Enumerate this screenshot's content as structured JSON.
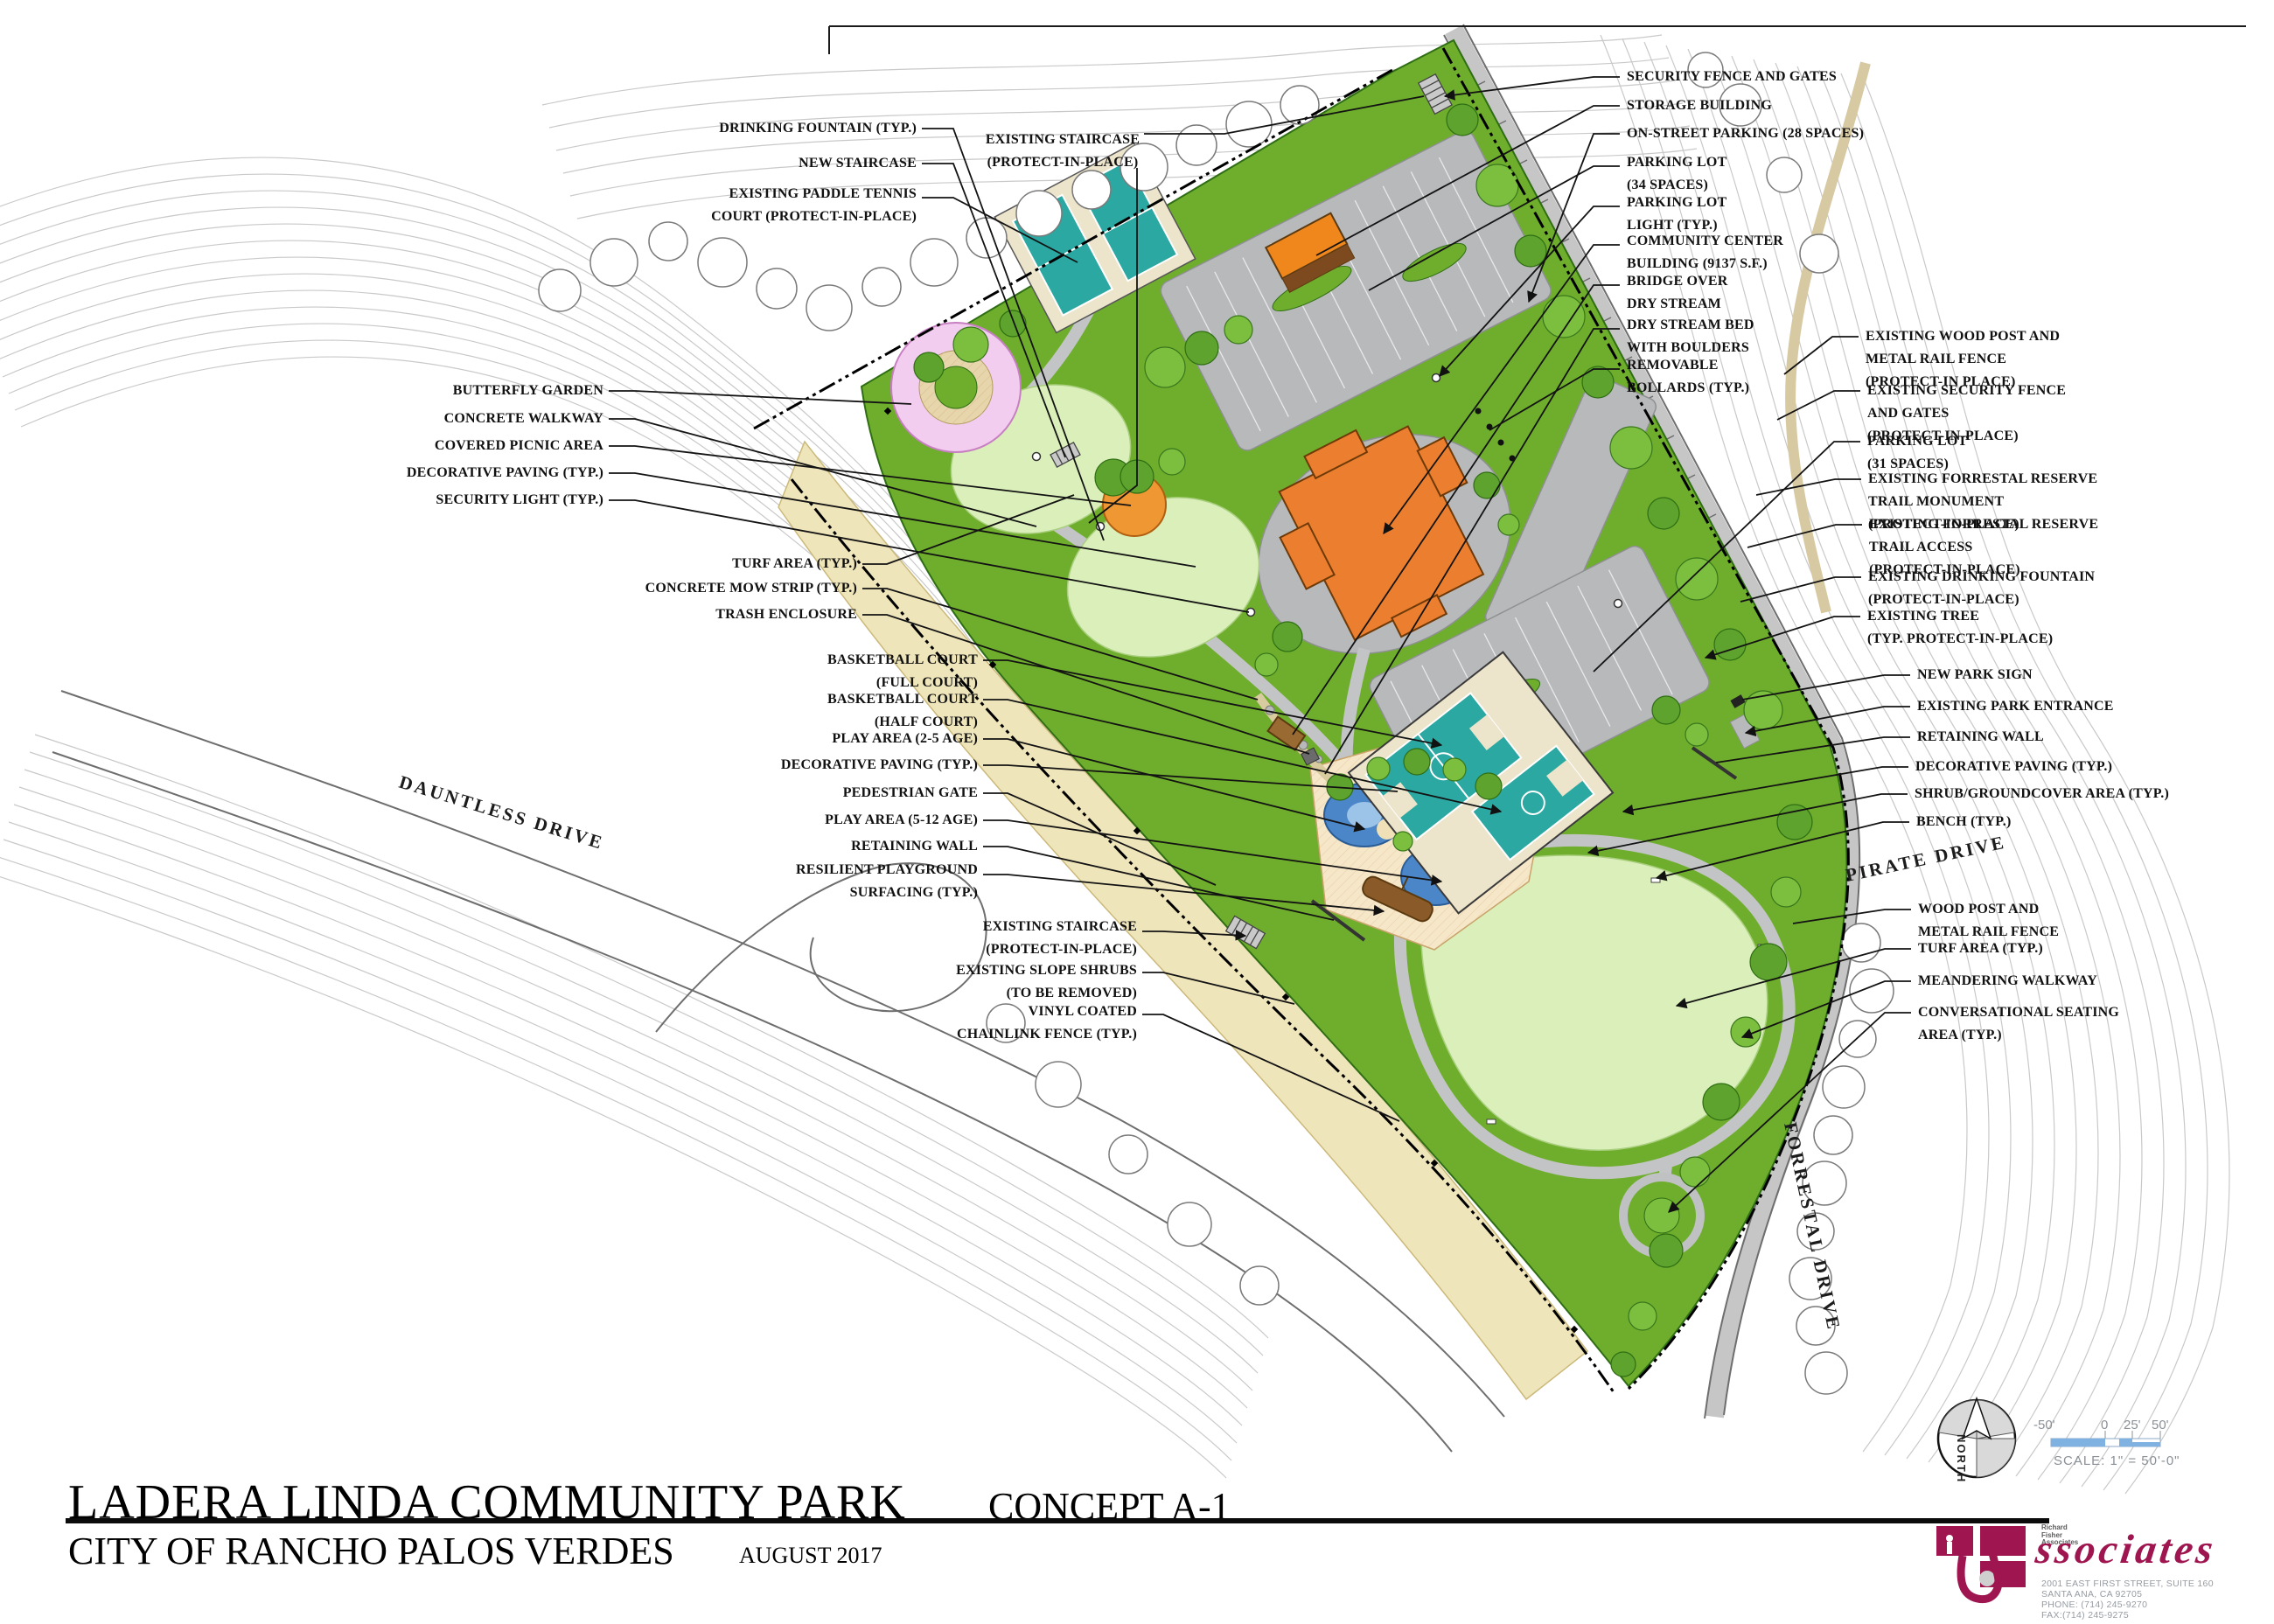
{
  "sheet": {
    "title": "LADERA LINDA COMMUNITY PARK",
    "concept": "CONCEPT A-1",
    "agency": "CITY OF RANCHO PALOS VERDES",
    "date": "AUGUST 2017"
  },
  "callouts": {
    "left": [
      {
        "lines": [
          "DRINKING FOUNTAIN (TYP.)"
        ]
      },
      {
        "lines": [
          "NEW STAIRCASE"
        ]
      },
      {
        "lines": [
          "EXISTING PADDLE TENNIS",
          "COURT (PROTECT-IN-PLACE)"
        ]
      },
      {
        "lines": [
          "EXISTING STAIRCASE",
          "(PROTECT-IN-PLACE)"
        ]
      },
      {
        "lines": [
          "BUTTERFLY GARDEN"
        ]
      },
      {
        "lines": [
          "CONCRETE WALKWAY"
        ]
      },
      {
        "lines": [
          "COVERED PICNIC AREA"
        ]
      },
      {
        "lines": [
          "DECORATIVE PAVING (TYP.)"
        ]
      },
      {
        "lines": [
          "SECURITY LIGHT (TYP.)"
        ]
      },
      {
        "lines": [
          "TURF AREA (TYP.)"
        ]
      },
      {
        "lines": [
          "CONCRETE MOW STRIP (TYP.)"
        ]
      },
      {
        "lines": [
          "TRASH ENCLOSURE"
        ]
      },
      {
        "lines": [
          "BASKETBALL COURT",
          "(FULL COURT)"
        ]
      },
      {
        "lines": [
          "BASKETBALL COURT",
          "(HALF COURT)"
        ]
      },
      {
        "lines": [
          "PLAY AREA (2-5 AGE)"
        ]
      },
      {
        "lines": [
          "DECORATIVE PAVING (TYP.)"
        ]
      },
      {
        "lines": [
          "PEDESTRIAN GATE"
        ]
      },
      {
        "lines": [
          "PLAY AREA (5-12 AGE)"
        ]
      },
      {
        "lines": [
          "RETAINING WALL"
        ]
      },
      {
        "lines": [
          "RESILIENT PLAYGROUND",
          "SURFACING (TYP.)"
        ]
      },
      {
        "lines": [
          "EXISTING STAIRCASE",
          "(PROTECT-IN-PLACE)"
        ]
      },
      {
        "lines": [
          "EXISTING SLOPE SHRUBS",
          "(TO BE REMOVED)"
        ]
      },
      {
        "lines": [
          "VINYL COATED",
          "CHAINLINK FENCE (TYP.)"
        ]
      }
    ],
    "right": [
      {
        "lines": [
          "SECURITY FENCE AND GATES"
        ]
      },
      {
        "lines": [
          "STORAGE BUILDING"
        ]
      },
      {
        "lines": [
          "ON-STREET PARKING (28 SPACES)"
        ]
      },
      {
        "lines": [
          "PARKING LOT",
          "(34 SPACES)"
        ]
      },
      {
        "lines": [
          "PARKING LOT",
          "LIGHT (TYP.)"
        ]
      },
      {
        "lines": [
          "COMMUNITY CENTER",
          "BUILDING (9137 S.F.)"
        ]
      },
      {
        "lines": [
          "BRIDGE OVER",
          "DRY STREAM"
        ]
      },
      {
        "lines": [
          "DRY STREAM BED",
          "WITH BOULDERS"
        ]
      },
      {
        "lines": [
          "REMOVABLE",
          "BOLLARDS (TYP.)"
        ]
      },
      {
        "lines": [
          "EXISTING WOOD POST AND",
          "METAL RAIL FENCE",
          "(PROTECT-IN PLACE)"
        ]
      },
      {
        "lines": [
          "EXISTING SECURITY FENCE",
          "AND GATES",
          "(PROTECT-IN-PLACE)"
        ]
      },
      {
        "lines": [
          "PARKING LOT",
          "(31 SPACES)"
        ]
      },
      {
        "lines": [
          "EXISTING FORRESTAL RESERVE",
          "TRAIL MONUMENT",
          "(PROTECT-IN-PLACE)"
        ]
      },
      {
        "lines": [
          "EXISTING FORRESTAL RESERVE",
          "TRAIL ACCESS",
          "(PROTECT-IN-PLACE)"
        ]
      },
      {
        "lines": [
          "EXISTING DRINKING FOUNTAIN",
          "(PROTECT-IN-PLACE)"
        ]
      },
      {
        "lines": [
          "EXISTING TREE",
          "(TYP. PROTECT-IN-PLACE)"
        ]
      },
      {
        "lines": [
          "NEW PARK SIGN"
        ]
      },
      {
        "lines": [
          "EXISTING PARK ENTRANCE"
        ]
      },
      {
        "lines": [
          "RETAINING WALL"
        ]
      },
      {
        "lines": [
          "DECORATIVE PAVING (TYP.)"
        ]
      },
      {
        "lines": [
          "SHRUB/GROUNDCOVER AREA (TYP.)"
        ]
      },
      {
        "lines": [
          "BENCH (TYP.)"
        ]
      },
      {
        "lines": [
          "WOOD POST AND",
          "METAL RAIL FENCE"
        ]
      },
      {
        "lines": [
          "TURF AREA (TYP.)"
        ]
      },
      {
        "lines": [
          "MEANDERING WALKWAY"
        ]
      },
      {
        "lines": [
          "CONVERSATIONAL SEATING",
          "AREA (TYP.)"
        ]
      }
    ]
  },
  "streets": {
    "dauntless": "DAUNTLESS DRIVE",
    "pirate": "PIRATE DRIVE",
    "forrestal": "FORRESTAL DRIVE"
  },
  "north_arrow": {
    "label": "NORTH"
  },
  "scale_bar": {
    "neg": "-50'",
    "zero": "0",
    "quarter": "25'",
    "half": "50'",
    "caption": "SCALE: 1\" = 50'-0\""
  },
  "logo": {
    "firm_lines": [
      "Richard",
      "Fisher",
      "Associates"
    ],
    "script": "ssociates",
    "address_lines": [
      "2001 EAST FIRST STREET, SUITE 160",
      "SANTA ANA, CA 92705",
      "PHONE: (714) 245-9270",
      "FAX:(714) 245-9275"
    ]
  },
  "legend_colors": {
    "park_green": "#6fae2c",
    "turf_light": "#daefba",
    "court_teal": "#2ba8a2",
    "building_orange": "#ec7f2f",
    "paving_gray": "#b7b9bb",
    "slope_beige": "#efe5bb",
    "play_blue": "#4a86c8",
    "butterfly_pink": "#f3cdef",
    "logo_maroon": "#9e1550",
    "scale_blue": "#7fb2e0"
  }
}
